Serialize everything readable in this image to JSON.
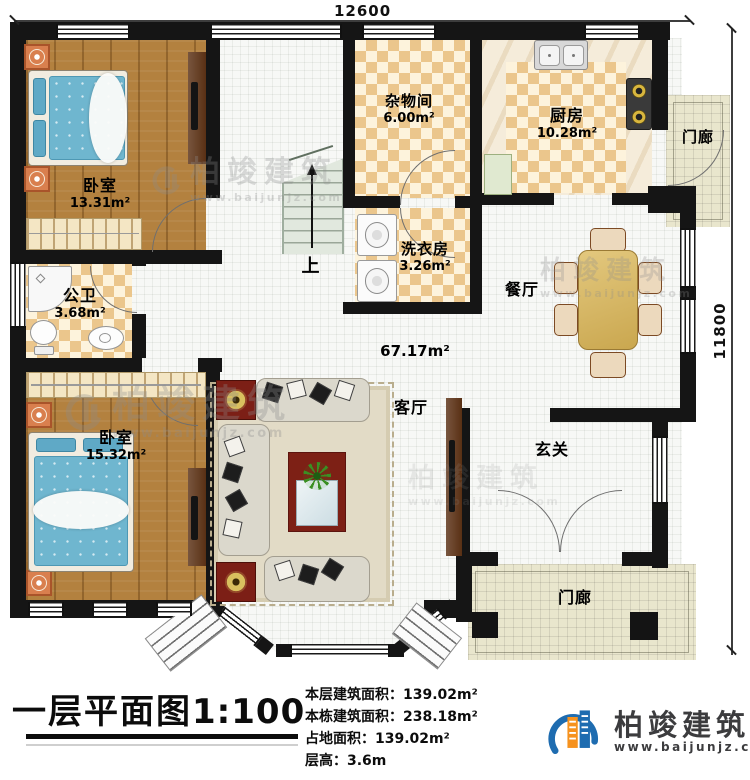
{
  "plan": {
    "dimension_top": "12600",
    "dimension_right": "11800",
    "rooms": {
      "bedroom1": {
        "name": "卧室",
        "area": "13.31m²"
      },
      "bedroom2": {
        "name": "卧室",
        "area": "15.32m²"
      },
      "bathroom": {
        "name": "公卫",
        "area": "3.68m²"
      },
      "storage": {
        "name": "杂物间",
        "area": "6.00m²"
      },
      "laundry": {
        "name": "洗衣房",
        "area": "3.26m²"
      },
      "kitchen": {
        "name": "厨房",
        "area": "10.28m²"
      },
      "dining": {
        "name": "餐厅"
      },
      "living": {
        "name": "客厅"
      },
      "foyer": {
        "name": "玄关"
      },
      "porch_top": {
        "name": "门廊"
      },
      "porch_bottom": {
        "name": "门廊"
      },
      "open_area_label": "67.17m²",
      "stairs_up": "上"
    }
  },
  "title_block": {
    "title": "一层平面图",
    "scale": "1:100",
    "stats": [
      {
        "label": "本层建筑面积：",
        "value": "139.02m²"
      },
      {
        "label": "本栋建筑面积：",
        "value": "238.18m²"
      },
      {
        "label": "占地面积：",
        "value": "139.02m²"
      },
      {
        "label": "层高：",
        "value": "3.6m"
      }
    ]
  },
  "branding": {
    "company": "柏竣建筑",
    "website": "www.baijunjz.com"
  },
  "watermark": {
    "company": "柏竣建筑",
    "website": "www.baijunjz.com"
  },
  "colors": {
    "wall": "#151515",
    "wood_floor": "#b3813f",
    "checker_tan": "#ebc68c",
    "checker_cream": "#fdf3dc",
    "porch": "#e9e6cd",
    "brand_blue": "#1e6cb0",
    "brand_orange": "#f6921e"
  }
}
